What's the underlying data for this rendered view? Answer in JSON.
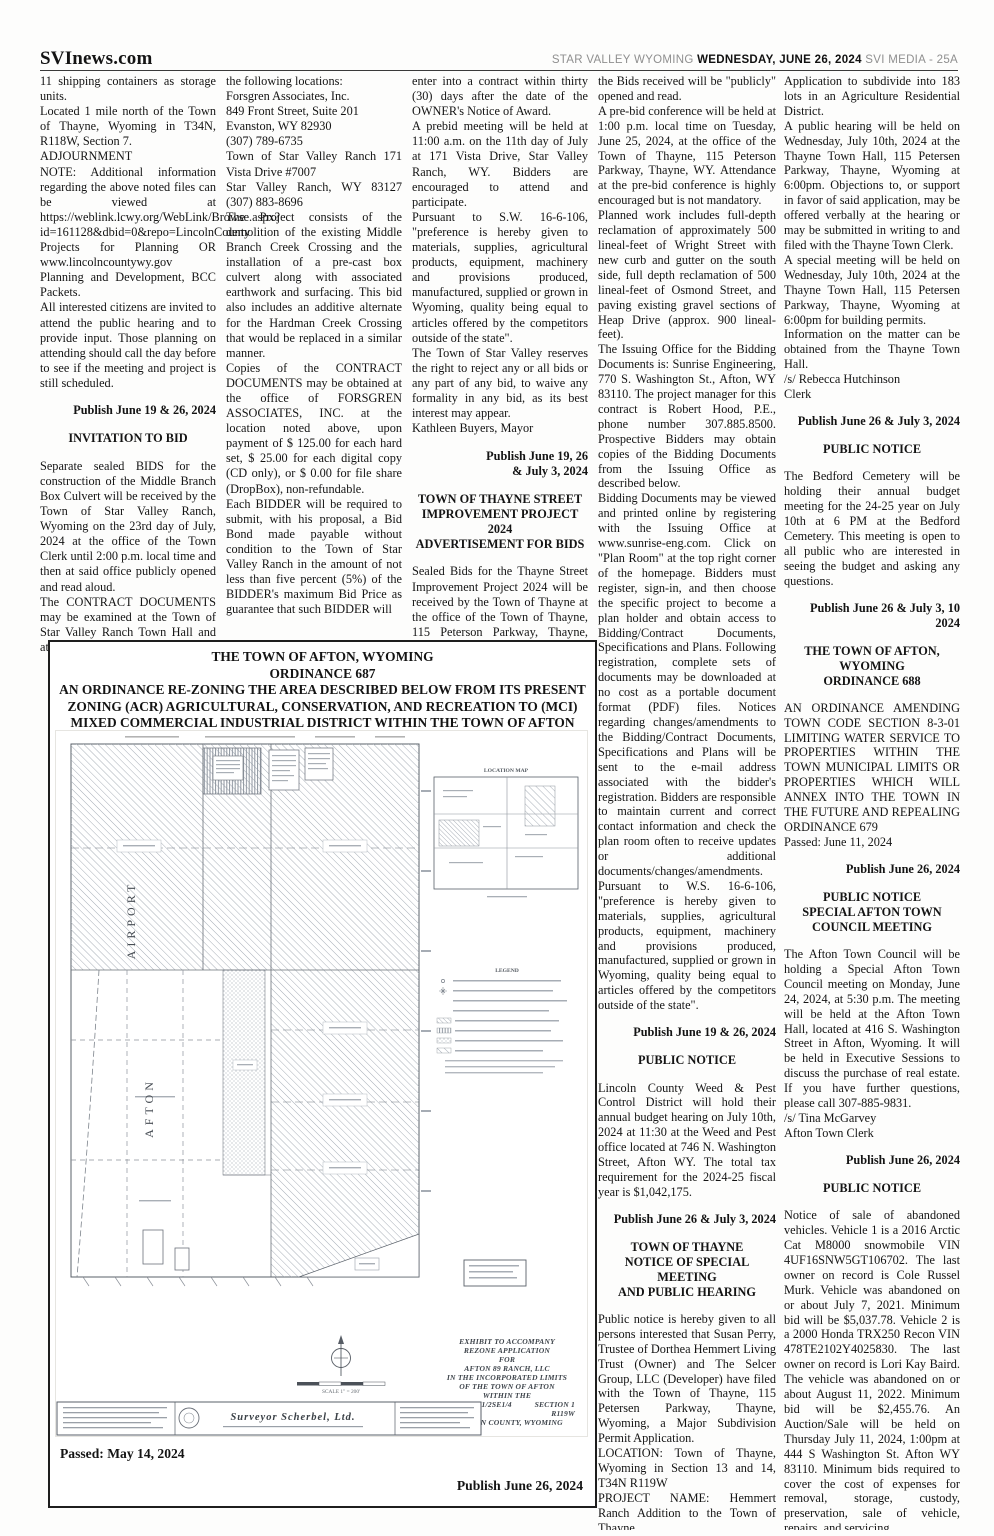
{
  "header": {
    "brand": "SVInews.com",
    "region": "STAR VALLEY WYOMING ",
    "date": "WEDNESDAY, JUNE 26, 2024",
    "edition": " SVI MEDIA - 25A"
  },
  "columns": {
    "c1": [
      "11 shipping containers as storage units.",
      "Located 1 mile north of the Town of Thayne, Wyoming in T34N, R118W, Section 7.",
      "ADJOURNMENT",
      "NOTE: Additional information regarding the above noted files can be viewed at https://weblink.lcwy.org/WebLink/Browse.aspx?id=161128&dbid=0&repo=LincolnCounty",
      "Projects for Planning OR www.lincolncountywy.gov Planning and Development, BCC Packets.",
      "All interested citizens are invited to attend the public hearing and to provide input.  Those planning on attending should call the day before to see if the meeting and project is still scheduled.",
      "Publish June 19 & 26, 2024",
      "INVITATION TO BID",
      "Separate sealed BIDS for the construction of the Middle Branch Box Culvert will be received by the Town of  Star Valley Ranch, Wyoming on the 23rd day of July, 2024 at the office of the Town Clerk until 2:00  p.m. local time and then at said office publicly opened and read aloud.",
      "The CONTRACT DOCUMENTS may be examined at the Town of Star Valley Ranch Town Hall and at"
    ],
    "c2": [
      "the following  locations:",
      "Forsgren Associates, Inc.",
      "849 Front Street, Suite 201",
      "Evanston, WY 82930",
      "(307) 789-6735",
      "Town of Star Valley Ranch   171 Vista Drive #7007",
      "Star Valley Ranch, WY 83127  (307) 883-8696",
      "The Project consists of the demolition of the existing Middle Branch Creek Crossing and the installation of a pre-cast  box culvert along with associated earthwork and surfacing. This bid also includes an additive alternate for the  Hardman Creek Crossing that would be replaced in a similar manner.",
      "Copies of the CONTRACT DOCUMENTS may be obtained at the office of FORSGREN ASSOCIATES, INC. at the location noted above, upon payment of $ 125.00 for each hard set, $ 25.00 for each digital copy (CD only), or  $ 0.00 for file share (DropBox), non-refundable.",
      "Each BIDDER will be required to submit, with his proposal, a Bid Bond made payable without condition to the Town of Star Valley Ranch in the amount of not less than five percent (5%) of the BIDDER's maximum Bid Price as guarantee  that such BIDDER will"
    ],
    "c3": [
      "enter into a contract within thirty (30) days after the date of the OWNER's Notice of Award.",
      "A prebid meeting will be held at 11:00 a.m. on the 11th day of July at 171 Vista Drive, Star  Valley Ranch, WY. Bidders are encouraged to attend and participate.",
      "Pursuant to S.W. 16-6-106, \"preference is hereby given to materials, supplies, agricultural products, equipment, machinery and provisions produced, manufactured, supplied or grown in Wyoming, quality being equal to articles offered by the competitors outside of the state\".",
      "The Town of Star Valley reserves the right to reject any or all bids or any part of any bid, to waive any formality in any  bid, as its best interest may appear.",
      "Kathleen Buyers, Mayor",
      "Publish June 19, 26\n& July 3, 2024",
      "TOWN OF THAYNE STREET\nIMPROVEMENT PROJECT 2024\nADVERTISEMENT FOR BIDS",
      "Sealed Bids for the Thayne Street Improvement Project 2024 will be received by the Town of Thayne at the office of the Town of Thayne, 115 Peterson Parkway, Thayne, WY 83127 until 1:00 p.m. local time on Tuesday, July 2, 2024, at which time"
    ],
    "c4": [
      "the Bids received will be \"publicly\" opened and read.",
      "A pre-bid conference will be held at 1:00 p.m. local time on Tuesday, June 25, 2024, at the office of the Town of Thayne, 115 Peterson Parkway, Thayne, WY. Attendance at the pre-bid conference is highly encouraged but is not mandatory.",
      "Planned work includes full-depth reclamation of approximately 500 lineal-feet of Wright Street with new curb and gutter on the south side, full depth reclamation of 500 lineal-feet of Osmond Street, and paving existing gravel sections of Heap Drive (approx. 900 lineal-feet).",
      "The Issuing Office for the Bidding Documents is: Sunrise Engineering, 770 S. Washington St., Afton, WY 83110. The project manager for this contract is Robert Hood, P.E., phone number 307.885.8500. Prospective Bidders may obtain copies of the Bidding Documents from the Issuing Office as described below.",
      "Bidding Documents may be viewed and printed online by registering with the Issuing Office at www.sunrise-eng.com. Click on \"Plan Room\" at the top right corner of the homepage. Bidders must register, sign-in, and then choose the specific project to become a plan holder and obtain access to Bidding/Contract Documents, Specifications and Plans. Following registration, complete sets of documents may be downloaded at no cost as a portable document format (PDF) files. Notices regarding changes/amendments to the Bidding/Contract Documents, Specifications and Plans will be sent to the e-mail address associated with the bidder's registration. Bidders are responsible to maintain current and correct contact information and check the plan room often to receive updates or additional documents/changes/amendments.",
      "Pursuant to W.S. 16-6-106, \"preference is hereby given to materials, supplies, agricultural products, equipment, machinery and provisions produced, manufactured, supplied or grown in Wyoming, quality being equal to articles offered by the competitors outside of the state\".",
      "Publish June 19 & 26, 2024",
      "PUBLIC NOTICE",
      "Lincoln County Weed & Pest Control District will hold their annual budget hearing on July 10th, 2024 at 11:30 at the Weed and Pest office located at 746 N. Washington Street, Afton WY.  The total tax requirement for the 2024-25 fiscal year is $1,042,175.",
      "Publish June 26 & July 3, 2024",
      "TOWN OF THAYNE\nNOTICE OF SPECIAL MEETING\nAND PUBLIC HEARING",
      "Public notice is hereby given to all persons interested that Susan Perry, Trustee of Dorthea Hemmert Living Trust (Owner) and The Selcer Group, LLC (Developer) have filed with the Town of Thayne, 115 Petersen Parkway, Thayne, Wyoming, a Major Subdivision Permit Application.",
      "LOCATION: Town of Thayne, Wyoming in Section 13 and 14, T34N R119W",
      "PROJECT NAME: Hemmert Ranch Addition to the Town of Thayne.",
      "PROJECT: A Major Subdivision"
    ],
    "c5": [
      "Application to subdivide into 183 lots in an Agriculture Residential District.",
      "A public hearing will be held on Wednesday, July 10th, 2024 at the Thayne Town Hall, 115 Petersen Parkway, Thayne, Wyoming at 6:00pm. Objections to, or support in favor of said application, may be offered verbally at the hearing or may be submitted in writing to and filed with the Thayne Town Clerk.",
      "A special meeting will be held on Wednesday, July 10th, 2024 at the Thayne Town Hall, 115 Petersen Parkway, Thayne, Wyoming at 6:00pm for building permits.",
      "Information on the matter can be obtained from the Thayne Town Hall.",
      "/s/ Rebecca Hutchinson",
      "Clerk",
      "Publish June 26 & July 3, 2024",
      "PUBLIC NOTICE",
      "The Bedford Cemetery will be holding their annual budget meeting for the 24-25 year on July 10th at 6 PM at the Bedford Cemetery. This meeting is open to all public who are interested in seeing the budget and asking any questions.",
      "Publish June 26 & July 3, 10\n2024",
      "THE TOWN OF AFTON,\nWYOMING\nORDINANCE 688",
      "AN ORDINANCE AMENDING TOWN CODE SECTION 8-3-01 LIMITING WATER SERVICE TO PROPERTIES WITHIN THE TOWN MUNICIPAL LIMITS OR PROPERTIES WHICH WILL ANNEX INTO THE TOWN IN THE FUTURE AND REPEALING ORDINANCE 679",
      "Passed: June 11, 2024",
      "Publish June 26, 2024",
      "PUBLIC NOTICE\nSPECIAL AFTON TOWN\nCOUNCIL MEETING",
      "The Afton Town Council will be holding a Special Afton Town Council meeting on Monday, June 24, 2024, at 5:30 p.m. The meeting will be held at the Afton Town Hall, located at 416 S. Washington Street in Afton, Wyoming. It will be held in Executive Sessions to discuss the purchase of real estate. If you have further questions, please call 307-885-9831.",
      "/s/ Tina McGarvey",
      "Afton Town Clerk",
      "Publish June 26, 2024",
      "PUBLIC NOTICE",
      "Notice of sale of abandoned vehicles. Vehicle 1 is a 2016 Arctic Cat M8000 snowmobile VIN 4UF16SNW5GT106702. The last owner on record is Cole Russel Murk. Vehicle was abandoned on or about July 7, 2021. Minimum bid will be $5,037.78. Vehicle 2 is a 2000 Honda TRX250 Recon VIN 478TE2102Y4025830. The last owner on record is Lori Kay Baird. The vehicle was abandoned on or about August 11, 2022. Minimum bid will be $2,455.76. An Auction/Sale will be held on Thursday July 11, 2024, 1:00pm at 444 S Washington St. Afton WY 83110. Minimum bids required to cover the cost of expenses for removal, storage, custody, preservation, sale of vehicle, repairs, and servicing.",
      "Publish June 26 & July 3, 2024"
    ]
  },
  "ordinance_box": {
    "title_line1": "THE TOWN OF AFTON, WYOMING",
    "title_line2": "ORDINANCE 687",
    "title_body": "AN ORDINANCE RE-ZONING THE AREA DESCRIBED BELOW FROM ITS PRESENT ZONING (ACR) AGRICULTURAL, CONSERVATION, AND RECREATION TO (MCI) MIXED COMMERCIAL INDUSTRIAL DISTRICT WITHIN THE TOWN OF AFTON",
    "passed": "Passed: May 14, 2024",
    "publish": "Publish June 26, 2024",
    "map": {
      "airport_label": "AIRPORT",
      "afton_label": "AFTON",
      "location_map_label": "LOCATION MAP",
      "legend_label": "LEGEND",
      "surveyor_label": "Surveyor Scherbel, Ltd.",
      "scale_label": "SCALE  1\" = 200'",
      "exhibit_lines": [
        "EXHIBIT TO ACCOMPANY",
        "REZONE APPLICATION",
        "FOR",
        "AFTON 89 RANCH, LLC",
        "IN THE INCORPORATED LIMITS",
        "OF THE TOWN OF AFTON",
        "WITHIN THE"
      ],
      "legal1_left": "E1/2SE1/4W1/2SE1/4",
      "legal1_right": "SECTION 1",
      "legal2_left": "T32N",
      "legal2_right": "R119W",
      "exhibit_last": "LINCOLN COUNTY, WYOMING"
    }
  }
}
